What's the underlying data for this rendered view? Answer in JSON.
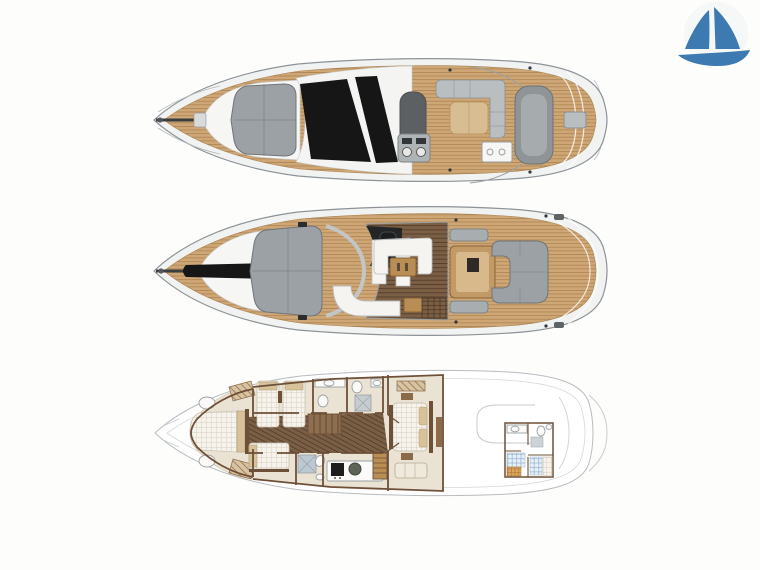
{
  "page": {
    "title": "Yacht deck plans",
    "background": "#fdfdfc"
  },
  "logo": {
    "label": "Sailboat brand logo",
    "color": "#3d7ab2"
  },
  "decks": [
    {
      "id": "flybridge",
      "label": "Flybridge and exterior top view"
    },
    {
      "id": "main-deck",
      "label": "Main deck layout"
    },
    {
      "id": "lower-deck",
      "label": "Lower deck accommodation layout"
    }
  ],
  "palette": {
    "logo_blue": "#3d7ab2",
    "hull_fill": "#f1f2f2",
    "hull_line": "#8d9296",
    "teak": "#cfa776",
    "teak_line": "#a07940",
    "glass_black": "#161616",
    "pad_gray": "#9ba1a5",
    "pad_line": "#6f7579",
    "sunroof_gray": "#5c6063",
    "structure_gray": "#8f9497",
    "sofa_white": "#f5f4f0",
    "tan_pad": "#d8bd93",
    "wood_floor": "#7b5f45",
    "wood_table": "#b98e55",
    "cabin_floor": "#eae3d3",
    "wall_brown": "#6e4f37",
    "mattress": "#f6f3ec",
    "pillow_tan": "#d7c29b",
    "crew_blue": "#e8f0f7",
    "seat_black": "#1b1d1f"
  }
}
